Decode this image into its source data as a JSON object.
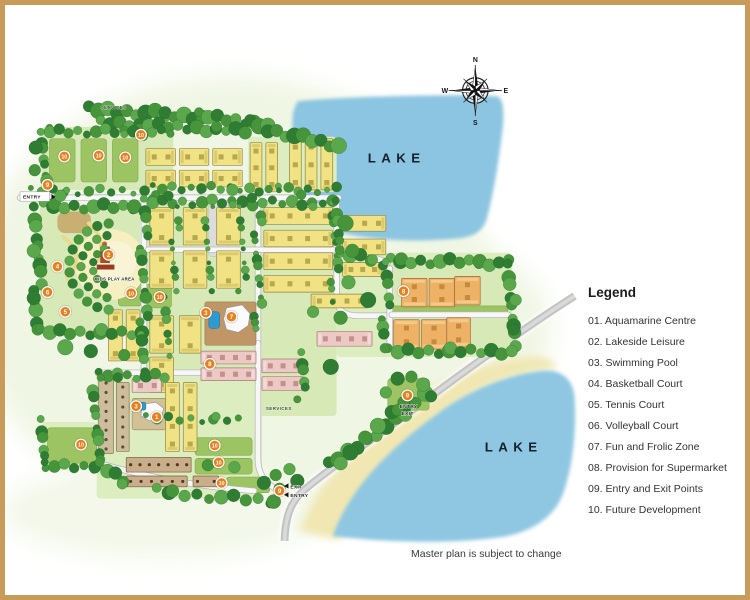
{
  "page": {
    "note": "Master plan is subject to change",
    "border_color": "#c89b58"
  },
  "legend": {
    "title": "Legend",
    "items": [
      "01. Aquamarine Centre",
      "02. Lakeside Leisure",
      "03. Swimming Pool",
      "04. Basketball Court",
      "05. Tennis Court",
      "06. Volleyball Court",
      "07. Fun and Frolic Zone",
      "08. Provision for Supermarket",
      "09. Entry and Exit Points",
      "10. Future Development"
    ]
  },
  "compass": {
    "n": "N",
    "e": "E",
    "s": "S",
    "w": "W"
  },
  "map": {
    "labels": {
      "lake_top": "LAKE",
      "lake_bottom": "LAKE",
      "entry_left": "ENTRY",
      "exit_bottom": "EXIT",
      "entry_bottom": "ENTRY",
      "entry_right": "ENTRY",
      "exit_right": "EXIT",
      "kids_play": "KIDS PLAY AREA",
      "services_top": "SERVICES",
      "services_bottom": "SERVICES"
    },
    "colors": {
      "lake": "#8cc5e1",
      "sand": "#f0e7b2",
      "road": "#c4c4c4",
      "marker": "#e8801e",
      "building_yellow": "#f1e283",
      "building_pink": "#ecc9c5",
      "building_orange": "#eeb266",
      "building_tan": "#cdbd9d",
      "tree_greens": [
        "#2e7d33",
        "#47953b",
        "#5aa84b"
      ]
    },
    "markers": [
      {
        "n": "9",
        "x": 42,
        "y": 183
      },
      {
        "n": "10",
        "x": 59,
        "y": 154
      },
      {
        "n": "10",
        "x": 94,
        "y": 153
      },
      {
        "n": "10",
        "x": 121,
        "y": 155
      },
      {
        "n": "10",
        "x": 137,
        "y": 132
      },
      {
        "n": "2",
        "x": 104,
        "y": 254
      },
      {
        "n": "4",
        "x": 52,
        "y": 266
      },
      {
        "n": "5",
        "x": 60,
        "y": 312
      },
      {
        "n": "6",
        "x": 42,
        "y": 292
      },
      {
        "n": "10",
        "x": 127,
        "y": 293
      },
      {
        "n": "10",
        "x": 156,
        "y": 297
      },
      {
        "n": "3",
        "x": 203,
        "y": 313
      },
      {
        "n": "7",
        "x": 229,
        "y": 317
      },
      {
        "n": "8",
        "x": 207,
        "y": 365
      },
      {
        "n": "3",
        "x": 132,
        "y": 408
      },
      {
        "n": "1",
        "x": 153,
        "y": 419
      },
      {
        "n": "10",
        "x": 76,
        "y": 447
      },
      {
        "n": "10",
        "x": 212,
        "y": 448
      },
      {
        "n": "10",
        "x": 216,
        "y": 465
      },
      {
        "n": "10",
        "x": 219,
        "y": 486
      },
      {
        "n": "9",
        "x": 278,
        "y": 494
      },
      {
        "n": "8",
        "x": 404,
        "y": 291
      },
      {
        "n": "9",
        "x": 408,
        "y": 397
      }
    ]
  }
}
